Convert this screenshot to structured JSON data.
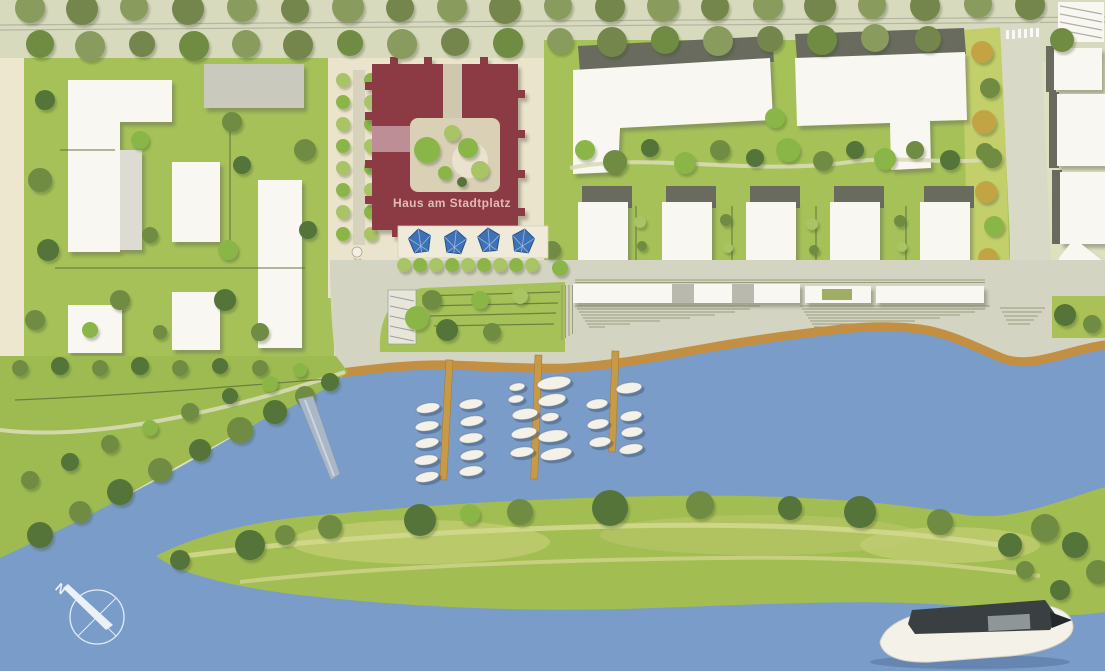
{
  "labels": {
    "building_label": "Haus am Stadtplatz",
    "compass_north": "N"
  },
  "colors": {
    "water": "#7a9cc8",
    "water_edge": "#c28f43",
    "grass": "#a5c158",
    "grass_island": "#a2bd52",
    "grass_yellow_strip": "#c3cf6a",
    "plaza": "#ebe4cc",
    "promenade": "#d4d4c2",
    "road_band": "#d8dabe",
    "left_margin": "#eee7d0",
    "accent_building": "#8c3a44",
    "accent_building_detail": "#bd8e96",
    "courtyard": "#d9d0b6",
    "building_white": "#f8f7f2",
    "roof_dark": "#686b5e",
    "pier": "#c79a48",
    "umbrella": "#3e72b6",
    "boat_hull": "#f4f1e8",
    "big_boat_cabin": "#3a4042",
    "label_text": "#e0bcb6",
    "compass": "#eaf1f7"
  },
  "map": {
    "type": "site-plan",
    "landmark_building": "Haus am Stadtplatz",
    "marina": {
      "piers": 3,
      "boats": 26
    },
    "plaza_umbrellas": 4,
    "compass_direction": "N"
  }
}
